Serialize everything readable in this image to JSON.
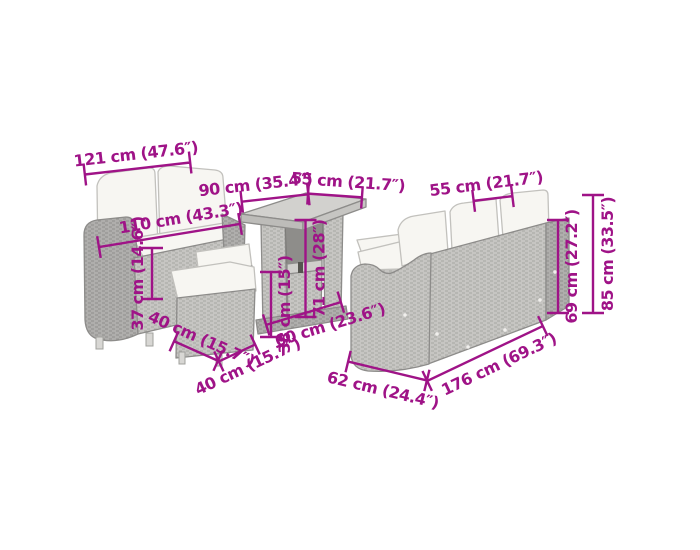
{
  "colors": {
    "accent": "#9f1387",
    "wicker": "#c6c5c2",
    "wicker_dark": "#b0afad",
    "cushion": "#f7f6f2",
    "outline": "#8d8c8a",
    "background": "#ffffff"
  },
  "diagram": {
    "type": "product-dimension-diagram",
    "subject": "poly-rattan-garden-lounge-set",
    "labels": {
      "sofa2_outer_width": "121 cm (47.6″)",
      "sofa2_inner_width": "110 cm (43.3″)",
      "sofa2_seat_height": "37 cm (14.6″)",
      "table_length": "90 cm (35.4″)",
      "table_width": "55 cm (21.7″)",
      "table_height": "71 cm (28″)",
      "table_shelf_height": "38 cm (15″)",
      "stool_depth": "40 cm (15.7″)",
      "stool_width": "40 cm (15.7″)",
      "floor_span": "60 cm (23.6″)",
      "sofa3_seat_width": "55 cm (21.7″)",
      "sofa3_back_height": "69 cm (27.2″)",
      "sofa3_total_height": "85 cm (33.5″)",
      "sofa3_depth": "62 cm (24.4″)",
      "sofa3_length": "176 cm (69.3″)"
    }
  }
}
